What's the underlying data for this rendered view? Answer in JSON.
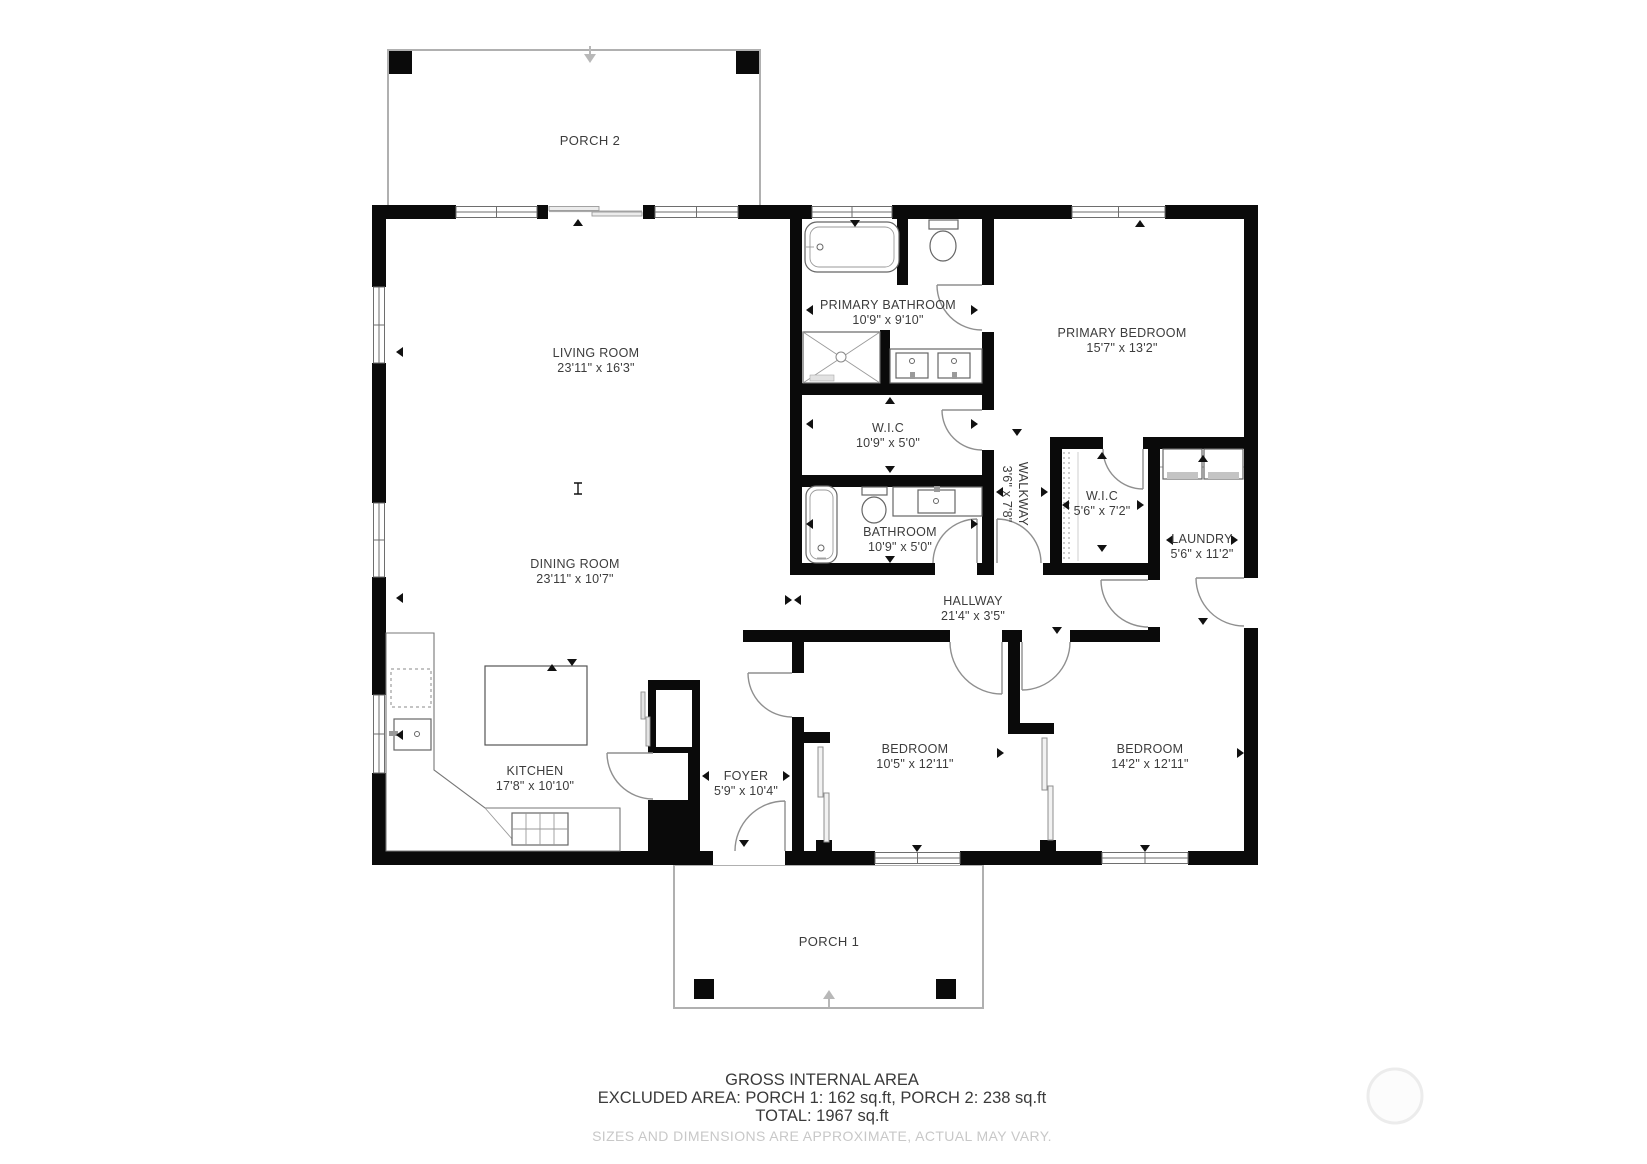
{
  "rooms": {
    "living_room": {
      "name": "LIVING ROOM",
      "dims": "23'11\" x 16'3\""
    },
    "dining_room": {
      "name": "DINING ROOM",
      "dims": "23'11\" x 10'7\""
    },
    "kitchen": {
      "name": "KITCHEN",
      "dims": "17'8\" x 10'10\""
    },
    "foyer": {
      "name": "FOYER",
      "dims": "5'9\" x 10'4\""
    },
    "primary_bathroom": {
      "name": "PRIMARY BATHROOM",
      "dims": "10'9\" x 9'10\""
    },
    "primary_bedroom": {
      "name": "PRIMARY BEDROOM",
      "dims": "15'7\" x 13'2\""
    },
    "wic_primary": {
      "name": "W.I.C",
      "dims": "10'9\" x 5'0\""
    },
    "bathroom": {
      "name": "BATHROOM",
      "dims": "10'9\" x 5'0\""
    },
    "walkway": {
      "name": "WALKWAY",
      "dims": "3'6\" x 7'8\""
    },
    "wic_hall": {
      "name": "W.I.C",
      "dims": "5'6\" x 7'2\""
    },
    "laundry": {
      "name": "LAUNDRY",
      "dims": "5'6\" x 11'2\""
    },
    "hallway": {
      "name": "HALLWAY",
      "dims": "21'4\" x 3'5\""
    },
    "bedroom_1": {
      "name": "BEDROOM",
      "dims": "10'5\" x 12'11\""
    },
    "bedroom_2": {
      "name": "BEDROOM",
      "dims": "14'2\" x 12'11\""
    }
  },
  "porches": {
    "porch_1": {
      "name": "PORCH 1"
    },
    "porch_2": {
      "name": "PORCH 2"
    }
  },
  "footer": {
    "line1": "GROSS INTERNAL AREA",
    "line2": "EXCLUDED AREA: PORCH 1: 162 sq.ft, PORCH 2: 238 sq.ft",
    "line3": "TOTAL: 1967 sq.ft",
    "disclaimer": "SIZES AND DIMENSIONS ARE APPROXIMATE, ACTUAL MAY VARY."
  },
  "colors": {
    "wall": "#0a0a0a",
    "label": "#3c3c3c",
    "disclaimer_text": "#c8c8c8",
    "porch_outline": "#b0b0b0"
  }
}
